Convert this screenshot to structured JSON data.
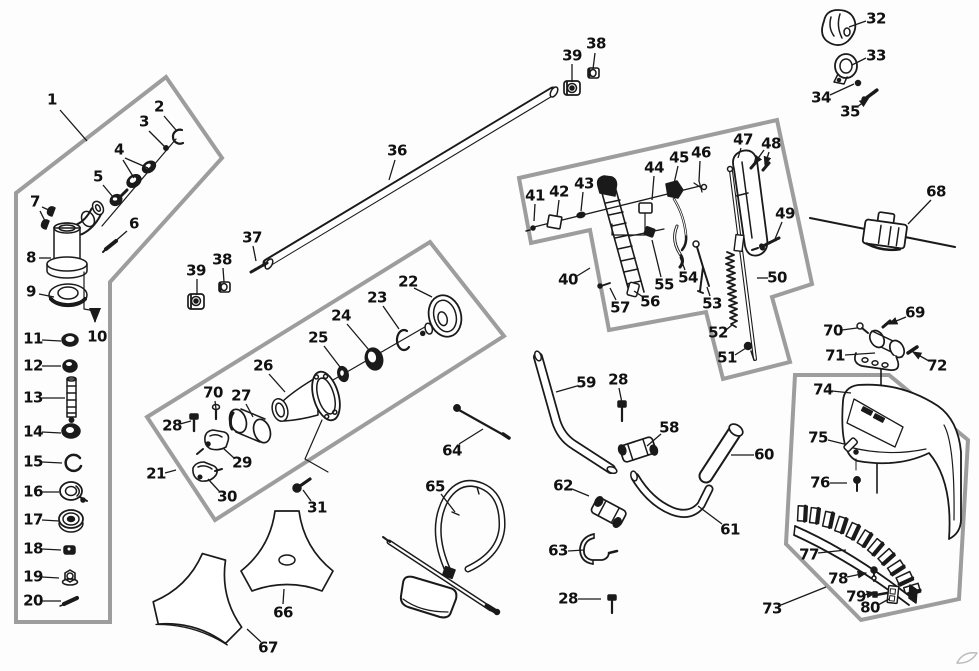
{
  "canvas": {
    "width": 979,
    "height": 671,
    "background": "#fdfdfd"
  },
  "colors": {
    "line": "#1a1a1a",
    "box_outline": "#9d9d9d",
    "watermark": "#bcbcbc"
  },
  "diagram_type": "exploded-parts-diagram",
  "labels": [
    {
      "n": "1",
      "x": 52,
      "y": 100,
      "l": [
        [
          60,
          110,
          87,
          141
        ]
      ]
    },
    {
      "n": "2",
      "x": 159,
      "y": 107,
      "l": [
        [
          164,
          116,
          176,
          130
        ]
      ]
    },
    {
      "n": "3",
      "x": 144,
      "y": 122,
      "l": [
        [
          149,
          131,
          164,
          146
        ]
      ]
    },
    {
      "n": "4",
      "x": 119,
      "y": 150,
      "l": [
        [
          125,
          158,
          148,
          168
        ],
        [
          123,
          160,
          134,
          178
        ]
      ]
    },
    {
      "n": "5",
      "x": 98,
      "y": 177,
      "l": [
        [
          103,
          185,
          113,
          197
        ]
      ]
    },
    {
      "n": "6",
      "x": 134,
      "y": 224,
      "l": [
        [
          127,
          231,
          112,
          244
        ]
      ]
    },
    {
      "n": "7",
      "x": 35,
      "y": 202,
      "l": [
        [
          42,
          207,
          51,
          211
        ],
        [
          40,
          211,
          45,
          221
        ]
      ]
    },
    {
      "n": "8",
      "x": 31,
      "y": 258,
      "l": [
        [
          39,
          258,
          51,
          258
        ]
      ]
    },
    {
      "n": "9",
      "x": 31,
      "y": 292,
      "l": [
        [
          39,
          294,
          54,
          297
        ]
      ]
    },
    {
      "n": "10",
      "x": 97,
      "y": 337
    },
    {
      "n": "11",
      "x": 33,
      "y": 339,
      "l": [
        [
          42,
          340,
          61,
          341
        ]
      ]
    },
    {
      "n": "12",
      "x": 33,
      "y": 366,
      "l": [
        [
          42,
          366,
          61,
          366
        ]
      ]
    },
    {
      "n": "13",
      "x": 33,
      "y": 398,
      "l": [
        [
          42,
          398,
          65,
          398
        ]
      ]
    },
    {
      "n": "14",
      "x": 33,
      "y": 432,
      "l": [
        [
          42,
          432,
          61,
          433
        ]
      ]
    },
    {
      "n": "15",
      "x": 33,
      "y": 462,
      "l": [
        [
          42,
          462,
          62,
          463
        ]
      ]
    },
    {
      "n": "16",
      "x": 33,
      "y": 492,
      "l": [
        [
          42,
          492,
          59,
          492
        ]
      ]
    },
    {
      "n": "17",
      "x": 33,
      "y": 520,
      "l": [
        [
          42,
          520,
          59,
          521
        ]
      ]
    },
    {
      "n": "18",
      "x": 33,
      "y": 549,
      "l": [
        [
          42,
          549,
          61,
          550
        ]
      ]
    },
    {
      "n": "19",
      "x": 33,
      "y": 577,
      "l": [
        [
          42,
          577,
          59,
          578
        ]
      ]
    },
    {
      "n": "20",
      "x": 33,
      "y": 601,
      "l": [
        [
          42,
          601,
          61,
          601
        ]
      ]
    },
    {
      "n": "21",
      "x": 156,
      "y": 474,
      "l": [
        [
          165,
          473,
          176,
          470
        ]
      ]
    },
    {
      "n": "22",
      "x": 408,
      "y": 282,
      "l": [
        [
          414,
          288,
          432,
          297
        ]
      ]
    },
    {
      "n": "23",
      "x": 377,
      "y": 298,
      "l": [
        [
          383,
          306,
          399,
          329
        ]
      ]
    },
    {
      "n": "24",
      "x": 341,
      "y": 316,
      "l": [
        [
          347,
          324,
          369,
          350
        ]
      ]
    },
    {
      "n": "25",
      "x": 318,
      "y": 338,
      "l": [
        [
          324,
          346,
          340,
          367
        ]
      ]
    },
    {
      "n": "26",
      "x": 263,
      "y": 366,
      "l": [
        [
          269,
          374,
          285,
          392
        ]
      ]
    },
    {
      "n": "27",
      "x": 241,
      "y": 396,
      "l": [
        [
          246,
          404,
          253,
          417
        ]
      ]
    },
    {
      "n": "70",
      "x": 213,
      "y": 393,
      "l": [
        [
          215,
          401,
          216,
          409
        ]
      ]
    },
    {
      "n": "28",
      "x": 172,
      "y": 426,
      "l": [
        [
          180,
          424,
          191,
          421
        ]
      ]
    },
    {
      "n": "29",
      "x": 242,
      "y": 463,
      "l": [
        [
          234,
          458,
          223,
          448
        ]
      ]
    },
    {
      "n": "30",
      "x": 227,
      "y": 497,
      "l": [
        [
          219,
          491,
          208,
          479
        ]
      ]
    },
    {
      "n": "31",
      "x": 317,
      "y": 508,
      "l": [
        [
          311,
          501,
          303,
          490
        ]
      ]
    },
    {
      "n": "36",
      "x": 397,
      "y": 151,
      "l": [
        [
          395,
          160,
          389,
          180
        ]
      ]
    },
    {
      "n": "37",
      "x": 252,
      "y": 238,
      "l": [
        [
          253,
          246,
          256,
          261
        ]
      ]
    },
    {
      "n": "38",
      "x": 222,
      "y": 260,
      "l": [
        [
          223,
          268,
          224,
          282
        ]
      ]
    },
    {
      "n": "39",
      "x": 196,
      "y": 271,
      "l": [
        [
          197,
          279,
          197,
          295
        ]
      ]
    },
    {
      "n": "38",
      "x": 596,
      "y": 44,
      "l": [
        [
          595,
          53,
          593,
          69
        ]
      ]
    },
    {
      "n": "39",
      "x": 572,
      "y": 56,
      "l": [
        [
          572,
          64,
          572,
          82
        ]
      ]
    },
    {
      "n": "32",
      "x": 876,
      "y": 19,
      "l": [
        [
          866,
          21,
          849,
          27
        ]
      ]
    },
    {
      "n": "33",
      "x": 876,
      "y": 56,
      "l": [
        [
          866,
          58,
          852,
          65
        ]
      ]
    },
    {
      "n": "34",
      "x": 821,
      "y": 98,
      "l": [
        [
          830,
          95,
          854,
          84
        ]
      ]
    },
    {
      "n": "35",
      "x": 850,
      "y": 112,
      "l": [
        [
          857,
          107,
          868,
          99
        ]
      ],
      "a": true
    },
    {
      "n": "40",
      "x": 568,
      "y": 280,
      "l": [
        [
          577,
          276,
          590,
          268
        ]
      ]
    },
    {
      "n": "41",
      "x": 535,
      "y": 196,
      "l": [
        [
          535,
          204,
          534,
          221
        ]
      ]
    },
    {
      "n": "42",
      "x": 559,
      "y": 192,
      "l": [
        [
          559,
          200,
          557,
          216
        ]
      ]
    },
    {
      "n": "43",
      "x": 584,
      "y": 184,
      "l": [
        [
          583,
          192,
          581,
          211
        ]
      ]
    },
    {
      "n": "44",
      "x": 654,
      "y": 168,
      "l": [
        [
          654,
          176,
          652,
          200
        ]
      ]
    },
    {
      "n": "45",
      "x": 679,
      "y": 158,
      "l": [
        [
          678,
          166,
          673,
          188
        ]
      ]
    },
    {
      "n": "46",
      "x": 701,
      "y": 153,
      "l": [
        [
          700,
          161,
          699,
          181
        ]
      ]
    },
    {
      "n": "47",
      "x": 743,
      "y": 140,
      "l": [
        [
          741,
          148,
          738,
          158
        ]
      ]
    },
    {
      "n": "48",
      "x": 771,
      "y": 144,
      "l": [
        [
          764,
          150,
          754,
          164
        ],
        [
          769,
          152,
          765,
          165
        ]
      ],
      "a": true
    },
    {
      "n": "49",
      "x": 785,
      "y": 214,
      "l": [
        [
          782,
          222,
          775,
          239
        ]
      ]
    },
    {
      "n": "50",
      "x": 777,
      "y": 278,
      "l": [
        [
          768,
          278,
          757,
          278
        ]
      ]
    },
    {
      "n": "51",
      "x": 727,
      "y": 358,
      "l": [
        [
          735,
          355,
          746,
          348
        ]
      ]
    },
    {
      "n": "52",
      "x": 718,
      "y": 333,
      "l": [
        [
          726,
          330,
          732,
          325
        ]
      ]
    },
    {
      "n": "53",
      "x": 712,
      "y": 304,
      "l": [
        [
          710,
          296,
          707,
          287
        ]
      ]
    },
    {
      "n": "54",
      "x": 688,
      "y": 278,
      "l": [
        [
          685,
          270,
          680,
          257
        ]
      ]
    },
    {
      "n": "55",
      "x": 664,
      "y": 285,
      "l": [
        [
          661,
          277,
          652,
          240
        ]
      ]
    },
    {
      "n": "56",
      "x": 650,
      "y": 302,
      "l": [
        [
          643,
          297,
          634,
          291
        ]
      ]
    },
    {
      "n": "57",
      "x": 620,
      "y": 308,
      "l": [
        [
          616,
          300,
          610,
          288
        ]
      ]
    },
    {
      "n": "58",
      "x": 669,
      "y": 428,
      "l": [
        [
          661,
          434,
          647,
          446
        ]
      ]
    },
    {
      "n": "59",
      "x": 586,
      "y": 383,
      "l": [
        [
          577,
          386,
          556,
          392
        ]
      ]
    },
    {
      "n": "28",
      "x": 618,
      "y": 380,
      "l": [
        [
          619,
          388,
          622,
          403
        ]
      ]
    },
    {
      "n": "60",
      "x": 764,
      "y": 455,
      "l": [
        [
          754,
          455,
          731,
          455
        ]
      ]
    },
    {
      "n": "61",
      "x": 730,
      "y": 530,
      "l": [
        [
          722,
          524,
          698,
          506
        ]
      ]
    },
    {
      "n": "62",
      "x": 563,
      "y": 486,
      "l": [
        [
          572,
          489,
          589,
          496
        ]
      ]
    },
    {
      "n": "63",
      "x": 558,
      "y": 551,
      "l": [
        [
          568,
          551,
          584,
          550
        ]
      ]
    },
    {
      "n": "28",
      "x": 568,
      "y": 599,
      "l": [
        [
          578,
          599,
          601,
          599
        ]
      ]
    },
    {
      "n": "64",
      "x": 452,
      "y": 451,
      "l": [
        [
          459,
          444,
          483,
          429
        ]
      ]
    },
    {
      "n": "65",
      "x": 435,
      "y": 487,
      "l": [
        [
          441,
          494,
          455,
          512
        ]
      ]
    },
    {
      "n": "66",
      "x": 283,
      "y": 613,
      "l": [
        [
          283,
          604,
          284,
          589
        ]
      ]
    },
    {
      "n": "67",
      "x": 268,
      "y": 648,
      "l": [
        [
          261,
          642,
          247,
          629
        ]
      ]
    },
    {
      "n": "68",
      "x": 936,
      "y": 192,
      "l": [
        [
          931,
          200,
          908,
          224
        ]
      ]
    },
    {
      "n": "69",
      "x": 915,
      "y": 313,
      "l": [
        [
          906,
          317,
          889,
          324
        ]
      ],
      "a": true
    },
    {
      "n": "70",
      "x": 833,
      "y": 331,
      "l": [
        [
          842,
          330,
          857,
          328
        ]
      ]
    },
    {
      "n": "71",
      "x": 835,
      "y": 356,
      "l": [
        [
          845,
          355,
          875,
          353
        ]
      ]
    },
    {
      "n": "72",
      "x": 937,
      "y": 366,
      "l": [
        [
          929,
          361,
          913,
          352
        ]
      ],
      "a": true
    },
    {
      "n": "73",
      "x": 772,
      "y": 609,
      "l": [
        [
          781,
          605,
          826,
          587
        ]
      ]
    },
    {
      "n": "74",
      "x": 823,
      "y": 390,
      "l": [
        [
          832,
          391,
          851,
          393
        ]
      ]
    },
    {
      "n": "75",
      "x": 818,
      "y": 438,
      "l": [
        [
          828,
          440,
          844,
          444
        ]
      ]
    },
    {
      "n": "76",
      "x": 820,
      "y": 483,
      "l": [
        [
          830,
          483,
          847,
          483
        ]
      ]
    },
    {
      "n": "77",
      "x": 809,
      "y": 555,
      "l": [
        [
          818,
          553,
          846,
          550
        ]
      ]
    },
    {
      "n": "78",
      "x": 838,
      "y": 579,
      "l": [
        [
          847,
          577,
          866,
          573
        ]
      ],
      "a": true
    },
    {
      "n": "79",
      "x": 856,
      "y": 597,
      "l": [
        [
          864,
          595,
          875,
          593
        ]
      ],
      "a": true
    },
    {
      "n": "80",
      "x": 870,
      "y": 608,
      "l": [
        [
          878,
          605,
          889,
          599
        ]
      ]
    }
  ]
}
